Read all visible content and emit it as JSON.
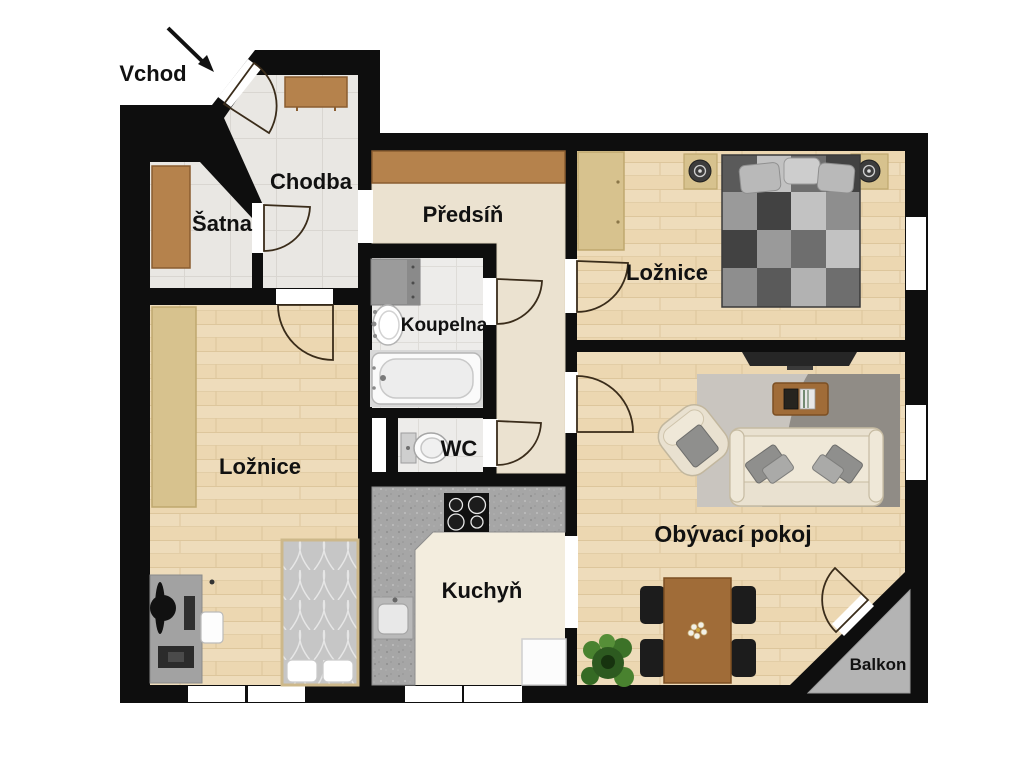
{
  "labels": {
    "entrance": "Vchod",
    "hallway": "Chodba",
    "closet": "Šatna",
    "anteroom": "Předsíň",
    "bathroom": "Koupelna",
    "wc": "WC",
    "bedroom_left": "Ložnice",
    "bedroom_right": "Ložnice",
    "kitchen": "Kuchyň",
    "living_room": "Obývací pokoj",
    "balcony": "Balkon"
  },
  "colors": {
    "wall": "#0e0e0e",
    "wood_floor": "#eedcbb",
    "tile_floor": "#e9e7e3",
    "anteroom_floor": "#ebe2d0",
    "kitchen_floor": "#f3edde",
    "counter": "#a6a6a6",
    "balcony_floor": "#b4b4b4",
    "furniture_wood": "#b5824c",
    "wardrobe_light": "#d7c28e",
    "background": "#ffffff"
  }
}
